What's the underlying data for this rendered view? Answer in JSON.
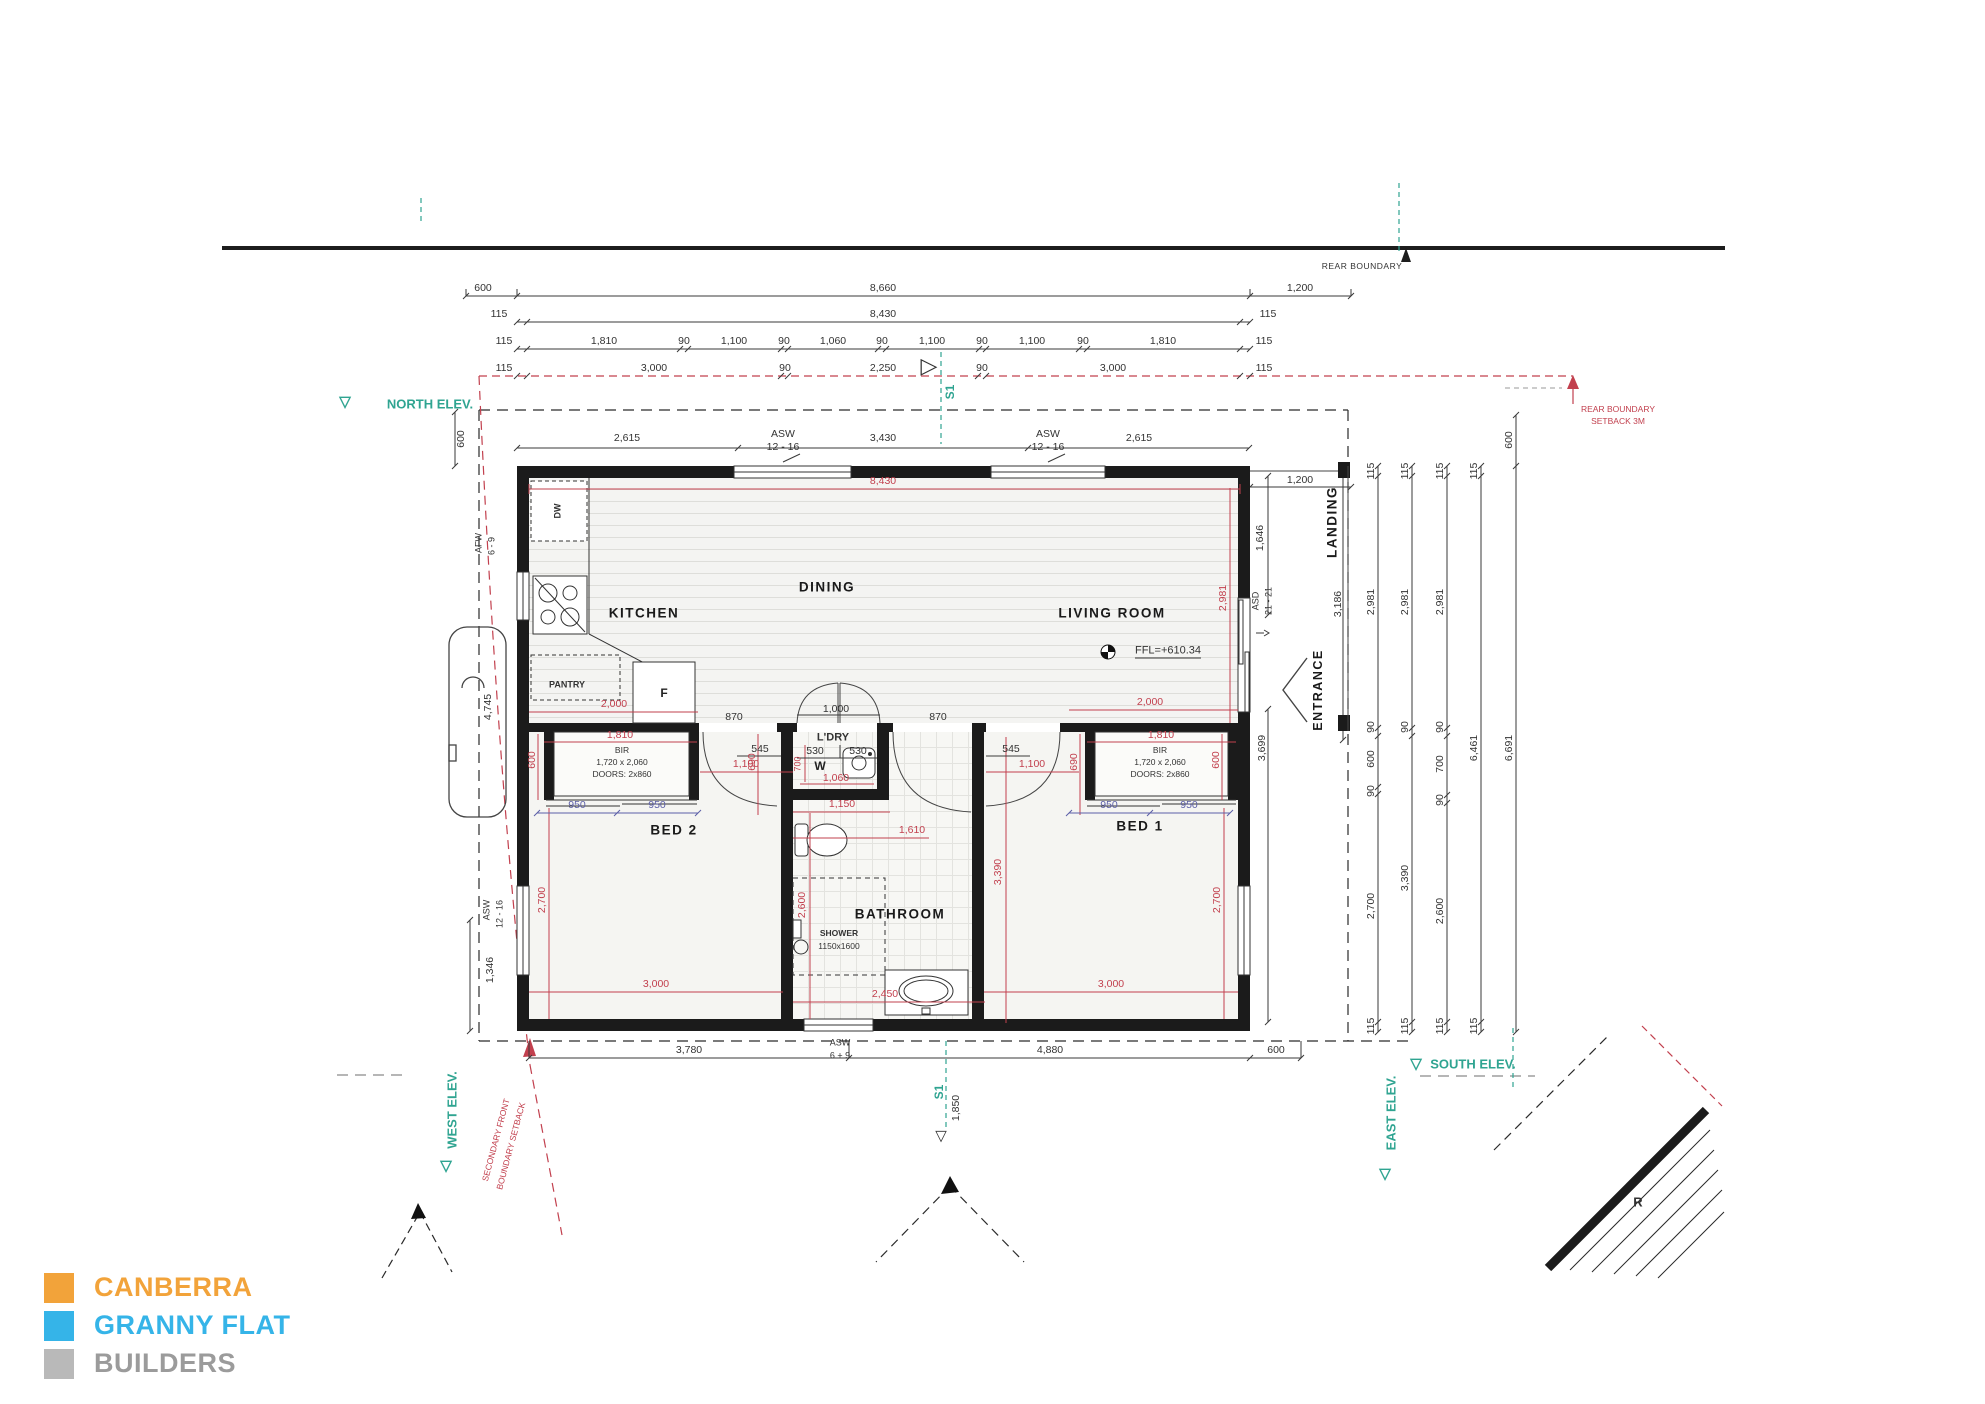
{
  "brand": {
    "line1": "CANBERRA",
    "line2": "GRANNY FLAT",
    "line3": "BUILDERS",
    "color1": "#f2a33a",
    "color2": "#35b4e8",
    "color3": "#a9a9a9"
  },
  "boundary": {
    "rear": "REAR BOUNDARY",
    "setback1": "REAR BOUNDARY",
    "setback2": "SETBACK 3M",
    "secondary1": "SECONDARY FRONT",
    "secondary2": "BOUNDARY SETBACK"
  },
  "elev": {
    "north": "NORTH ELEV.",
    "west": "WEST ELEV.",
    "south": "SOUTH ELEV.",
    "east": "EAST ELEV."
  },
  "marker": {
    "s1_top": "S1",
    "s1_bottom": "S1",
    "dim_1850": "1,850",
    "r": "R",
    "tri_down": "▽",
    "tri_right": "▷"
  },
  "rooms": {
    "kitchen": "KITCHEN",
    "dining": "DINING",
    "living": "LIVING ROOM",
    "bed1": "BED 1",
    "bed2": "BED 2",
    "bathroom": "BATHROOM",
    "ldry": "L'DRY",
    "landing": "LANDING",
    "entrance": "ENTRANCE",
    "pantry": "PANTRY"
  },
  "fixtures": {
    "dw": "DW",
    "fridge": "F",
    "washer": "W",
    "shower1": "SHOWER",
    "shower2": "1150x1600",
    "ffl": "FFL=+610.34",
    "bir": "BIR",
    "bir_size": "1,720 x 2,060",
    "bir_doors": "DOORS: 2x860"
  },
  "windows": {
    "asw": "ASW",
    "asw_size": "12 - 16",
    "afw": "AFW",
    "afw_size": "6 - 9",
    "aswb": "ASW",
    "aswb_size": "6 + 9",
    "asd": "ASD",
    "asd_size": "21 - 21"
  },
  "dims": {
    "t1": [
      "600",
      "8,660",
      "1,200"
    ],
    "t2": [
      "115",
      "8,430",
      "115"
    ],
    "t3": [
      "115",
      "1,810",
      "90",
      "1,100",
      "90",
      "1,060",
      "90",
      "1,100",
      "90",
      "1,100",
      "90",
      "1,810",
      "115"
    ],
    "t4": [
      "115",
      "3,000",
      "90",
      "2,250",
      "90",
      "3,000",
      "115"
    ],
    "win_row": [
      "2,615",
      "3,430",
      "2,615"
    ],
    "red_8430": "8,430",
    "bottom": [
      "3,780",
      "4,880",
      "600"
    ],
    "rc1": [
      "115",
      "2,981",
      "90",
      "600",
      "90",
      "2,700",
      "115"
    ],
    "rc2": [
      "115",
      "2,981",
      "90",
      "3,390",
      "115"
    ],
    "rc3": [
      "115",
      "2,981",
      "90",
      "700",
      "90",
      "2,600",
      "115"
    ],
    "rc4": [
      "115",
      "6,461",
      "115"
    ],
    "rc5": [
      "600",
      "6,691"
    ],
    "left": [
      "600",
      "4,745",
      "1,346"
    ],
    "landing": [
      "1,200",
      "1,646",
      "3,186",
      "3,699"
    ],
    "living": {
      "w2000": "2,000",
      "v2981": "2,981"
    },
    "kitchen": {
      "w2000": "2,000"
    },
    "bed2": {
      "w1810": "1,810",
      "v600": "600",
      "v690": "690",
      "d950a": "950",
      "d950b": "950",
      "w1100": "1,100",
      "v2700": "2,700",
      "w3000": "3,000",
      "d545": "545"
    },
    "bed1": {
      "w1810": "1,810",
      "v690": "690",
      "v600": "600",
      "d950a": "950",
      "d950b": "950",
      "w1100": "1,100",
      "v2700": "2,700",
      "w3000": "3,000",
      "d545": "545"
    },
    "ldry": {
      "d530a": "530",
      "d530b": "530",
      "v700": "700",
      "w1060": "1,060",
      "w1000": "1,000",
      "d870a": "870",
      "d870b": "870"
    },
    "bath": {
      "w1150": "1,150",
      "w1610": "1,610",
      "v2600": "2,600",
      "v3390": "3,390",
      "w2450": "2,450"
    }
  }
}
